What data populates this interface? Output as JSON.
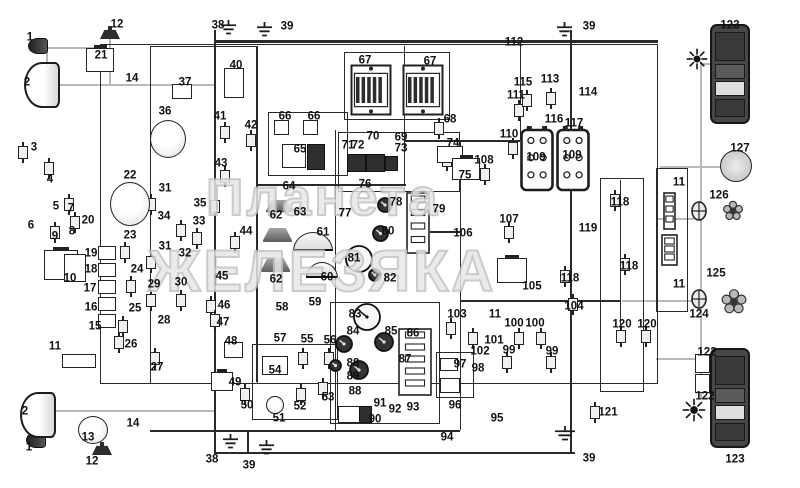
{
  "watermark": {
    "line1": "Планета",
    "line2": "ЖЕЛЕЗЯКА",
    "color": "#c2c2c2"
  },
  "palette": {
    "line": "#2a2a2a",
    "gray_wire": "#b8b8b8",
    "dark_fill": "#3a3a3a",
    "label": "#111111",
    "background": "#ffffff"
  },
  "labels": [
    [
      "1",
      30,
      38
    ],
    [
      "2",
      27,
      83
    ],
    [
      "3",
      34,
      148
    ],
    [
      "4",
      50,
      180
    ],
    [
      "5",
      56,
      207
    ],
    [
      "7",
      71,
      209
    ],
    [
      "6",
      31,
      226
    ],
    [
      "9",
      55,
      237
    ],
    [
      "8",
      72,
      232
    ],
    [
      "10",
      70,
      279
    ],
    [
      "20",
      88,
      221
    ],
    [
      "19",
      91,
      254
    ],
    [
      "18",
      91,
      270
    ],
    [
      "17",
      90,
      289
    ],
    [
      "16",
      91,
      308
    ],
    [
      "15",
      95,
      327
    ],
    [
      "11",
      55,
      347
    ],
    [
      "12",
      117,
      25
    ],
    [
      "21",
      101,
      56
    ],
    [
      "14",
      132,
      79
    ],
    [
      "22",
      130,
      176
    ],
    [
      "23",
      130,
      236
    ],
    [
      "24",
      137,
      270
    ],
    [
      "25",
      135,
      309
    ],
    [
      "26",
      131,
      345
    ],
    [
      "27",
      157,
      368
    ],
    [
      "2",
      25,
      412
    ],
    [
      "1",
      29,
      448
    ],
    [
      "12",
      92,
      462
    ],
    [
      "13",
      88,
      438
    ],
    [
      "14",
      133,
      424
    ],
    [
      "29",
      154,
      285
    ],
    [
      "30",
      181,
      283
    ],
    [
      "28",
      164,
      321
    ],
    [
      "31",
      165,
      189
    ],
    [
      "34",
      164,
      217
    ],
    [
      "35",
      200,
      204
    ],
    [
      "33",
      199,
      222
    ],
    [
      "31",
      165,
      247
    ],
    [
      "32",
      185,
      254
    ],
    [
      "36",
      165,
      112
    ],
    [
      "37",
      185,
      83
    ],
    [
      "38",
      218,
      26
    ],
    [
      "39",
      287,
      27
    ],
    [
      "40",
      236,
      66
    ],
    [
      "41",
      220,
      117
    ],
    [
      "42",
      251,
      126
    ],
    [
      "43",
      221,
      164
    ],
    [
      "44",
      246,
      232
    ],
    [
      "45",
      222,
      277
    ],
    [
      "46",
      224,
      306
    ],
    [
      "47",
      223,
      323
    ],
    [
      "48",
      231,
      342
    ],
    [
      "49",
      235,
      383
    ],
    [
      "50",
      247,
      406
    ],
    [
      "51",
      279,
      419
    ],
    [
      "52",
      300,
      407
    ],
    [
      "53",
      328,
      398
    ],
    [
      "54",
      275,
      371
    ],
    [
      "55",
      307,
      340
    ],
    [
      "56",
      330,
      341
    ],
    [
      "57",
      280,
      339
    ],
    [
      "58",
      282,
      308
    ],
    [
      "59",
      315,
      303
    ],
    [
      "60",
      327,
      278
    ],
    [
      "61",
      323,
      233
    ],
    [
      "62",
      276,
      216
    ],
    [
      "63",
      300,
      213
    ],
    [
      "62",
      276,
      280
    ],
    [
      "64",
      289,
      187
    ],
    [
      "65",
      300,
      150
    ],
    [
      "66",
      285,
      117
    ],
    [
      "66",
      314,
      117
    ],
    [
      "67",
      365,
      61
    ],
    [
      "67",
      430,
      62
    ],
    [
      "68",
      450,
      120
    ],
    [
      "70",
      373,
      137
    ],
    [
      "69",
      401,
      138
    ],
    [
      "71",
      348,
      146
    ],
    [
      "72",
      358,
      146
    ],
    [
      "73",
      401,
      149
    ],
    [
      "74",
      453,
      144
    ],
    [
      "75",
      465,
      176
    ],
    [
      "76",
      365,
      185
    ],
    [
      "77",
      345,
      214
    ],
    [
      "78",
      396,
      203
    ],
    [
      "79",
      439,
      210
    ],
    [
      "80",
      388,
      232
    ],
    [
      "81",
      354,
      259
    ],
    [
      "82",
      390,
      279
    ],
    [
      "83",
      355,
      315
    ],
    [
      "84",
      353,
      332
    ],
    [
      "85",
      391,
      332
    ],
    [
      "86",
      413,
      334
    ],
    [
      "87",
      405,
      360
    ],
    [
      "88",
      353,
      364
    ],
    [
      "89",
      353,
      377
    ],
    [
      "88",
      355,
      392
    ],
    [
      "90",
      375,
      420
    ],
    [
      "91",
      380,
      404
    ],
    [
      "92",
      395,
      410
    ],
    [
      "93",
      413,
      408
    ],
    [
      "94",
      447,
      438
    ],
    [
      "95",
      497,
      419
    ],
    [
      "96",
      455,
      406
    ],
    [
      "97",
      460,
      365
    ],
    [
      "98",
      478,
      369
    ],
    [
      "99",
      509,
      351
    ],
    [
      "99",
      552,
      352
    ],
    [
      "100",
      514,
      324
    ],
    [
      "100",
      535,
      324
    ],
    [
      "101",
      494,
      341
    ],
    [
      "102",
      480,
      352
    ],
    [
      "103",
      457,
      315
    ],
    [
      "104",
      574,
      307
    ],
    [
      "105",
      532,
      287
    ],
    [
      "106",
      463,
      234
    ],
    [
      "107",
      509,
      220
    ],
    [
      "108",
      484,
      161
    ],
    [
      "109",
      536,
      158
    ],
    [
      "109",
      572,
      156
    ],
    [
      "110",
      509,
      135
    ],
    [
      "111",
      516,
      96
    ],
    [
      "112",
      514,
      43
    ],
    [
      "113",
      550,
      80
    ],
    [
      "114",
      588,
      93
    ],
    [
      "115",
      523,
      83
    ],
    [
      "116",
      554,
      120
    ],
    [
      "117",
      574,
      124
    ],
    [
      "118",
      620,
      203
    ],
    [
      "119",
      588,
      229
    ],
    [
      "118",
      629,
      267
    ],
    [
      "118",
      570,
      279
    ],
    [
      "120",
      622,
      325
    ],
    [
      "120",
      647,
      325
    ],
    [
      "121",
      608,
      413
    ],
    [
      "122",
      707,
      353
    ],
    [
      "122",
      705,
      397
    ],
    [
      "11",
      495,
      315
    ],
    [
      "11",
      679,
      183
    ],
    [
      "11",
      679,
      285
    ],
    [
      "123",
      730,
      26
    ],
    [
      "123",
      735,
      460
    ],
    [
      "124",
      699,
      315
    ],
    [
      "125",
      716,
      274
    ],
    [
      "126",
      719,
      196
    ],
    [
      "127",
      740,
      149
    ],
    [
      "38",
      212,
      460
    ],
    [
      "39",
      249,
      466
    ],
    [
      "39",
      589,
      459
    ],
    [
      "39",
      589,
      27
    ]
  ],
  "frames": [
    [
      100,
      44,
      556,
      338,
      1.5
    ],
    [
      150,
      46,
      64,
      336,
      1.2
    ],
    [
      214,
      46,
      42,
      336,
      1.2
    ],
    [
      344,
      52,
      104,
      66,
      1.2
    ],
    [
      268,
      112,
      78,
      62,
      1.2
    ],
    [
      338,
      132,
      120,
      58,
      1.2
    ],
    [
      330,
      302,
      108,
      120,
      1.5
    ],
    [
      600,
      178,
      42,
      212,
      1.2
    ],
    [
      656,
      168,
      30,
      142,
      1.5
    ],
    [
      252,
      344,
      84,
      74,
      1.2
    ],
    [
      436,
      352,
      36,
      44,
      1.2
    ]
  ],
  "wires": [
    [
      "h",
      214,
      40,
      444,
      3,
      "k"
    ],
    [
      "h",
      256,
      184,
      150,
      1.5,
      "k"
    ],
    [
      "h",
      404,
      140,
      116,
      1.5,
      "k"
    ],
    [
      "h",
      430,
      231,
      30,
      1.5,
      "k"
    ],
    [
      "h",
      460,
      300,
      160,
      1.5,
      "k"
    ],
    [
      "h",
      150,
      430,
      310,
      1.5,
      "k"
    ],
    [
      "h",
      214,
      452,
      361,
      1.5,
      "k"
    ],
    [
      "h",
      52,
      84,
      162,
      2,
      "g"
    ],
    [
      "h",
      46,
      47,
      54,
      2,
      "g"
    ],
    [
      "h",
      50,
      410,
      164,
      2,
      "g"
    ],
    [
      "h",
      658,
      218,
      36,
      2,
      "g"
    ],
    [
      "h",
      622,
      300,
      72,
      2,
      "g"
    ],
    [
      "h",
      660,
      166,
      62,
      2,
      "g"
    ],
    [
      "h",
      700,
      63,
      12,
      2,
      "g"
    ],
    [
      "h",
      700,
      397,
      12,
      2,
      "g"
    ],
    [
      "h",
      656,
      358,
      40,
      2,
      "g"
    ],
    [
      "v",
      214,
      30,
      422,
      1.5,
      "k"
    ],
    [
      "v",
      256,
      46,
      336,
      1.2,
      "k"
    ],
    [
      "v",
      335,
      130,
      300,
      1.2,
      "k"
    ],
    [
      "v",
      404,
      46,
      138,
      1.2,
      "k"
    ],
    [
      "v",
      460,
      140,
      290,
      1.2,
      "k"
    ],
    [
      "v",
      520,
      41,
      99,
      1.2,
      "k"
    ],
    [
      "v",
      570,
      30,
      422,
      1.5,
      "k"
    ],
    [
      "v",
      620,
      180,
      150,
      1.2,
      "k"
    ],
    [
      "v",
      247,
      430,
      24,
      1.5,
      "k"
    ],
    [
      "v",
      700,
      63,
      336,
      2,
      "g"
    ],
    [
      "v",
      109,
      39,
      45,
      2,
      "g"
    ],
    [
      "v",
      46,
      47,
      37,
      2,
      "g"
    ]
  ],
  "sensors": [
    [
      18,
      146
    ],
    [
      44,
      162
    ],
    [
      64,
      198
    ],
    [
      70,
      216
    ],
    [
      50,
      226
    ],
    [
      120,
      246
    ],
    [
      126,
      280
    ],
    [
      118,
      320
    ],
    [
      114,
      336
    ],
    [
      150,
      352
    ],
    [
      146,
      294
    ],
    [
      176,
      294
    ],
    [
      146,
      198
    ],
    [
      146,
      256
    ],
    [
      192,
      232
    ],
    [
      176,
      224
    ],
    [
      210,
      200
    ],
    [
      220,
      126
    ],
    [
      246,
      134
    ],
    [
      220,
      170
    ],
    [
      230,
      236
    ],
    [
      206,
      300
    ],
    [
      210,
      314
    ],
    [
      240,
      388
    ],
    [
      296,
      388
    ],
    [
      318,
      382
    ],
    [
      298,
      352
    ],
    [
      324,
      352
    ],
    [
      434,
      122
    ],
    [
      442,
      154
    ],
    [
      468,
      332
    ],
    [
      446,
      322
    ],
    [
      502,
      356
    ],
    [
      546,
      356
    ],
    [
      514,
      332
    ],
    [
      536,
      332
    ],
    [
      504,
      226
    ],
    [
      480,
      168
    ],
    [
      508,
      142
    ],
    [
      514,
      104
    ],
    [
      546,
      92
    ],
    [
      522,
      94
    ],
    [
      610,
      194
    ],
    [
      620,
      258
    ],
    [
      560,
      270
    ],
    [
      616,
      330
    ],
    [
      641,
      330
    ],
    [
      590,
      406
    ],
    [
      568,
      298
    ]
  ],
  "components": [
    [
      "marker-lamp-1-top",
      "smallamp",
      28,
      38,
      18,
      14
    ],
    [
      "headlamp-2-top",
      "headlamp",
      24,
      62,
      32,
      42
    ],
    [
      "marker-lamp-1-bottom",
      "smallamp",
      26,
      432,
      18,
      14
    ],
    [
      "headlamp-2-bottom",
      "headlamp",
      20,
      392,
      32,
      42
    ],
    [
      "horn-12-top",
      "horn",
      100,
      26,
      20,
      13
    ],
    [
      "horn-12-bottom",
      "horn",
      92,
      442,
      20,
      13
    ],
    [
      "relay-21",
      "relay",
      86,
      48,
      26,
      22
    ],
    [
      "ignition-coil-13",
      "circlecomp",
      78,
      416,
      28,
      26
    ],
    [
      "alternator-22",
      "circlecomp",
      110,
      182,
      38,
      42
    ],
    [
      "distributor-36",
      "circlecomp",
      150,
      120,
      34,
      36
    ],
    [
      "switch-37",
      "box",
      172,
      84,
      18,
      13
    ],
    [
      "component-40",
      "box",
      224,
      68,
      18,
      28
    ],
    [
      "battery-10",
      "relay",
      44,
      250,
      32,
      28
    ],
    [
      "component-8",
      "box",
      64,
      254,
      20,
      26
    ],
    [
      "fuse-19",
      "box",
      98,
      246,
      16,
      12
    ],
    [
      "fuse-18",
      "box",
      98,
      263,
      16,
      12
    ],
    [
      "fuse-17",
      "box",
      98,
      280,
      16,
      12
    ],
    [
      "fuse-16",
      "box",
      98,
      297,
      16,
      12
    ],
    [
      "fuse-15",
      "box",
      98,
      314,
      16,
      12
    ],
    [
      "junction-11-left",
      "box",
      62,
      354,
      32,
      12
    ],
    [
      "lamp-shade-62-a",
      "shade",
      266,
      200,
      26,
      15
    ],
    [
      "lamp-shade-62-b",
      "shade",
      263,
      228,
      29,
      17
    ],
    [
      "lamp-shade-62-c",
      "shade",
      261,
      258,
      29,
      17
    ],
    [
      "plafond-61",
      "dome",
      293,
      232,
      38,
      16
    ],
    [
      "plafond-60",
      "dome",
      306,
      262,
      30,
      13
    ],
    [
      "component-65-a",
      "box",
      282,
      144,
      22,
      22
    ],
    [
      "component-65-b",
      "darkbox",
      307,
      144,
      16,
      24
    ],
    [
      "socket-66-a",
      "box",
      274,
      120,
      13,
      13
    ],
    [
      "socket-66-b",
      "box",
      303,
      120,
      13,
      13
    ],
    [
      "fuse-block-67-a",
      "fusebox",
      350,
      64,
      42,
      52
    ],
    [
      "fuse-block-67-b",
      "fusebox",
      402,
      64,
      42,
      52
    ],
    [
      "relay-71",
      "darkbox",
      347,
      154,
      17,
      16
    ],
    [
      "relay-72",
      "darkbox",
      366,
      154,
      17,
      16
    ],
    [
      "relay-69",
      "darkbox",
      385,
      156,
      11,
      13
    ],
    [
      "component-74",
      "box",
      437,
      146,
      24,
      15
    ],
    [
      "relay-75",
      "relay",
      452,
      158,
      26,
      20
    ],
    [
      "gauge-78",
      "gauge",
      376,
      196,
      18,
      18
    ],
    [
      "gauge-80",
      "gauge",
      371,
      224,
      19,
      19
    ],
    [
      "gauge-81",
      "gauge",
      344,
      244,
      30,
      30
    ],
    [
      "gauge-82",
      "gauge",
      367,
      267,
      16,
      16
    ],
    [
      "fuse-panel-79",
      "panel",
      406,
      192,
      24,
      62
    ],
    [
      "speedometer-83",
      "gauge",
      352,
      302,
      30,
      30
    ],
    [
      "gauge-84",
      "gauge",
      334,
      334,
      20,
      20
    ],
    [
      "gauge-85",
      "gauge",
      373,
      331,
      22,
      22
    ],
    [
      "gauge-88",
      "gauge",
      328,
      358,
      15,
      15
    ],
    [
      "gauge-89",
      "gauge",
      348,
      359,
      22,
      22
    ],
    [
      "instrument-panel-86-87",
      "panel",
      398,
      328,
      34,
      68
    ],
    [
      "component-90",
      "box",
      338,
      406,
      20,
      15
    ],
    [
      "component-90-b",
      "darkbox",
      359,
      406,
      11,
      15
    ],
    [
      "fuse-54",
      "box",
      262,
      356,
      24,
      17
    ],
    [
      "sensor-51",
      "circlecomp",
      266,
      396,
      16,
      16
    ],
    [
      "component-48",
      "box",
      224,
      342,
      17,
      14
    ],
    [
      "relay-49",
      "relay",
      211,
      372,
      20,
      17
    ],
    [
      "battery-109-a",
      "battery",
      520,
      126,
      34,
      66
    ],
    [
      "battery-109-b",
      "battery",
      556,
      126,
      34,
      66
    ],
    [
      "relay-105",
      "relay",
      497,
      258,
      28,
      23
    ],
    [
      "component-96",
      "box",
      440,
      378,
      18,
      13
    ],
    [
      "component-97",
      "box",
      440,
      358,
      16,
      11
    ],
    [
      "tail-lamp-123-top",
      "taillamp",
      710,
      24,
      36,
      96
    ],
    [
      "tail-lamp-123-bottom",
      "taillamp",
      710,
      348,
      36,
      96
    ],
    [
      "lamp-127",
      "lampcircle",
      720,
      150,
      30,
      30
    ],
    [
      "flasher-icon-top",
      "star",
      686,
      48,
      22,
      22
    ],
    [
      "flasher-icon-bottom",
      "star",
      682,
      398,
      24,
      24
    ],
    [
      "connector-126",
      "connector",
      690,
      200,
      18,
      22
    ],
    [
      "connector-125",
      "connector",
      690,
      288,
      18,
      22
    ],
    [
      "daisy-icon-a",
      "daisy",
      722,
      200,
      22,
      22
    ],
    [
      "daisy-icon-b",
      "daisy",
      720,
      288,
      28,
      28
    ],
    [
      "connector-11-right-a",
      "panel",
      663,
      192,
      13,
      38
    ],
    [
      "connector-11-right-b",
      "panel",
      661,
      234,
      17,
      32
    ],
    [
      "connector-122-a",
      "box",
      695,
      354,
      13,
      17
    ],
    [
      "connector-122-b",
      "box",
      695,
      374,
      13,
      17
    ],
    [
      "ground-38-top",
      "ground",
      220,
      20,
      17,
      15
    ],
    [
      "ground-39-top-a",
      "ground",
      256,
      22,
      17,
      15
    ],
    [
      "ground-39-top-b",
      "ground",
      556,
      22,
      17,
      15
    ],
    [
      "ground-38-bottom",
      "ground",
      222,
      434,
      17,
      15
    ],
    [
      "ground-39-bottom-a",
      "ground",
      258,
      440,
      17,
      15
    ],
    [
      "ground-39-bottom-b",
      "ground",
      554,
      426,
      22,
      15
    ]
  ]
}
